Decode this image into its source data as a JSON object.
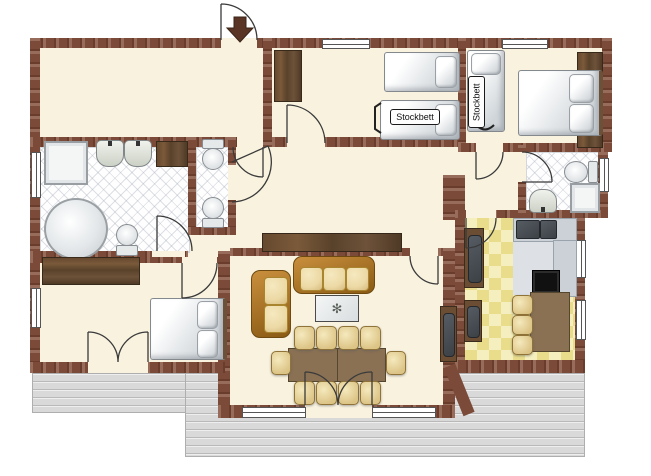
{
  "labels": {
    "bunk_bed": "Stockbett"
  },
  "icons": {
    "plant": "✻",
    "entrance_arrow": "arrow-down"
  },
  "colors": {
    "wall": "#7b4a38",
    "floor": "#f8f2df",
    "terrace": "#d9d9d9",
    "kitchen_tile_a": "#f5efbf",
    "kitchen_tile_b": "#e9dd8c",
    "sofa_frame": "#c98f3d",
    "cushion": "#ecd9a5",
    "dining_table": "#8a7154",
    "sideboard": "#5d4331",
    "counter": "#ccd1d8",
    "appliance": "#3c4146",
    "door_arc": "#3a3a3a",
    "entrance_arrow": "#5a3526"
  }
}
